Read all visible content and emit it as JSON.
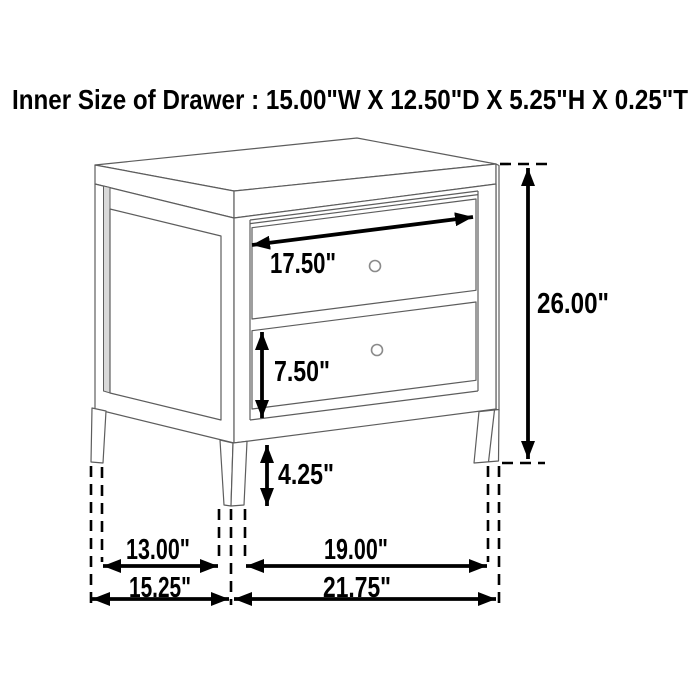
{
  "title": "Inner Size of Drawer : 15.00\"W X 12.50\"D X 5.25\"H X 0.25\"T",
  "figure": {
    "type": "furniture-dimension-diagram",
    "item": "two-drawer nightstand",
    "dimensions": {
      "drawer_width": "17.50\"",
      "bottom_drawer_height": "7.50\"",
      "leg_height": "4.25\"",
      "overall_height": "26.00\"",
      "side_leg_span_inner": "13.00\"",
      "front_leg_span_inner": "19.00\"",
      "overall_depth": "15.25\"",
      "overall_width": "21.75\""
    }
  },
  "colors": {
    "background": "#ffffff",
    "artwork_line": "#5d5d5d",
    "dimension_ink": "#000000",
    "stile_shade": "#d9d9d9"
  }
}
